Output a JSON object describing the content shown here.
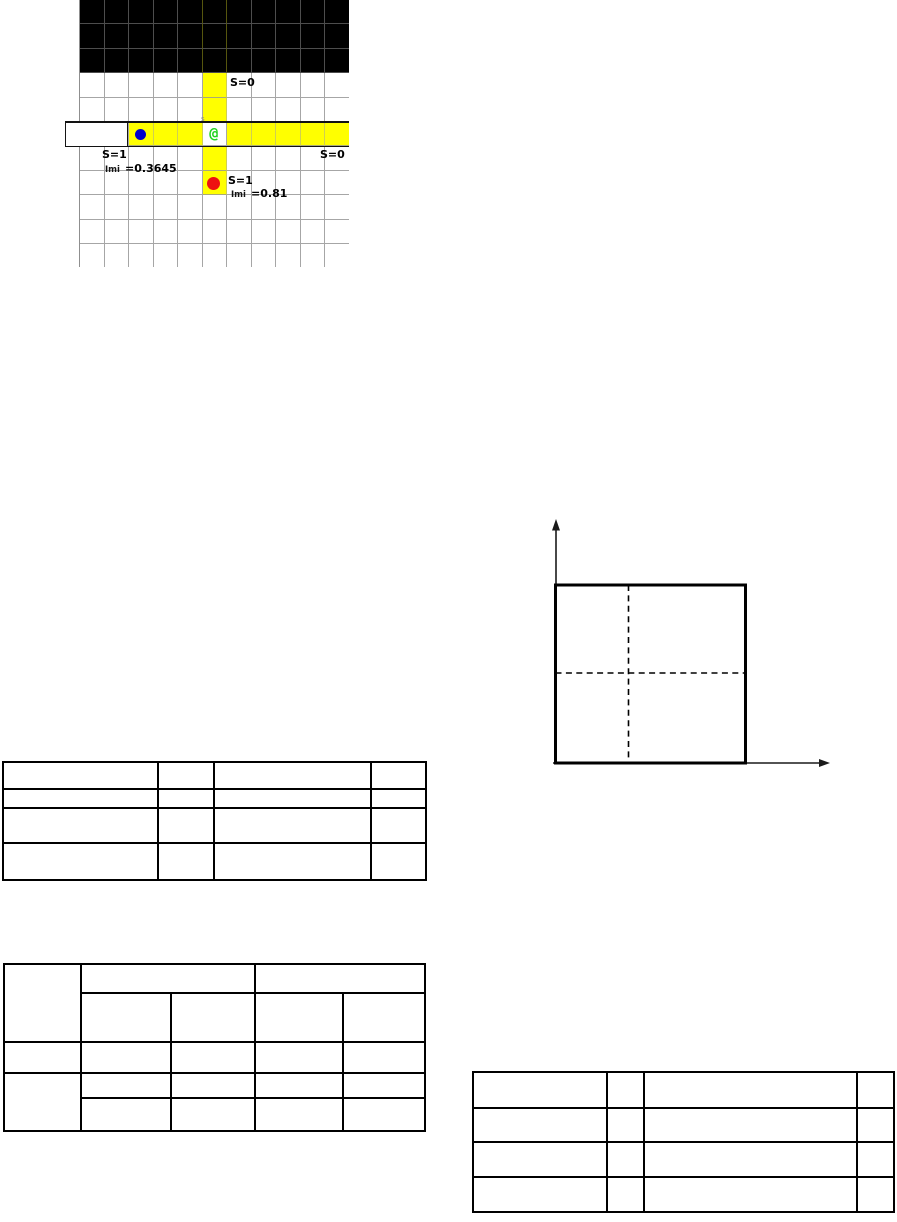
{
  "page": {
    "background": "#ffffff"
  },
  "maze_figure": {
    "grid": {
      "rows": 11,
      "cols": 11,
      "wall_rows": 3,
      "corridor_row": 5,
      "corridor_row_start_col": 2,
      "corridor_col": 5,
      "corridor_col_start_row": 3,
      "corridor_col_end_row": 7,
      "agent_row": 5,
      "agent_col": 5,
      "blue_dot": {
        "row": 5,
        "col": 2
      },
      "red_dot": {
        "row": 7,
        "col": 5
      }
    },
    "labels": {
      "corridor_top": "S=0",
      "start_s": "S=1",
      "start_imi_label": "Imi",
      "start_imi_value": "=0.3645",
      "corridor_right": "S=0",
      "goal_s": "S=1",
      "goal_imi_label": "Imi",
      "goal_imi_value": "=0.81",
      "agent_glyph": "@",
      "agent_mark": "s"
    },
    "colors": {
      "wall": "#000000",
      "corridor": "#ffff00",
      "grid_line": "#a6a6a6",
      "wall_line": "#4d4d4d",
      "agent_green": "#1fd41f",
      "dot_blue": "#0000cd",
      "dot_red": "#ee1111"
    }
  },
  "diagram": {
    "elements": [
      "y-axis-arrow",
      "x-axis-arrow",
      "square",
      "dashed-vertical-divider",
      "dashed-horizontal-divider"
    ]
  },
  "tables": {
    "top_left": {
      "rows": 4,
      "cols": 4,
      "cells_empty": true
    },
    "bottom_left": {
      "rows": 5,
      "cols": 5,
      "cells_empty": true,
      "merges": [
        "r0c0-rowspan2",
        "r0c1-colspan2",
        "r0c3-colspan2",
        "r3c0-rowspan2"
      ]
    },
    "bottom_right": {
      "rows": 4,
      "cols": 4,
      "cells_empty": true
    }
  }
}
